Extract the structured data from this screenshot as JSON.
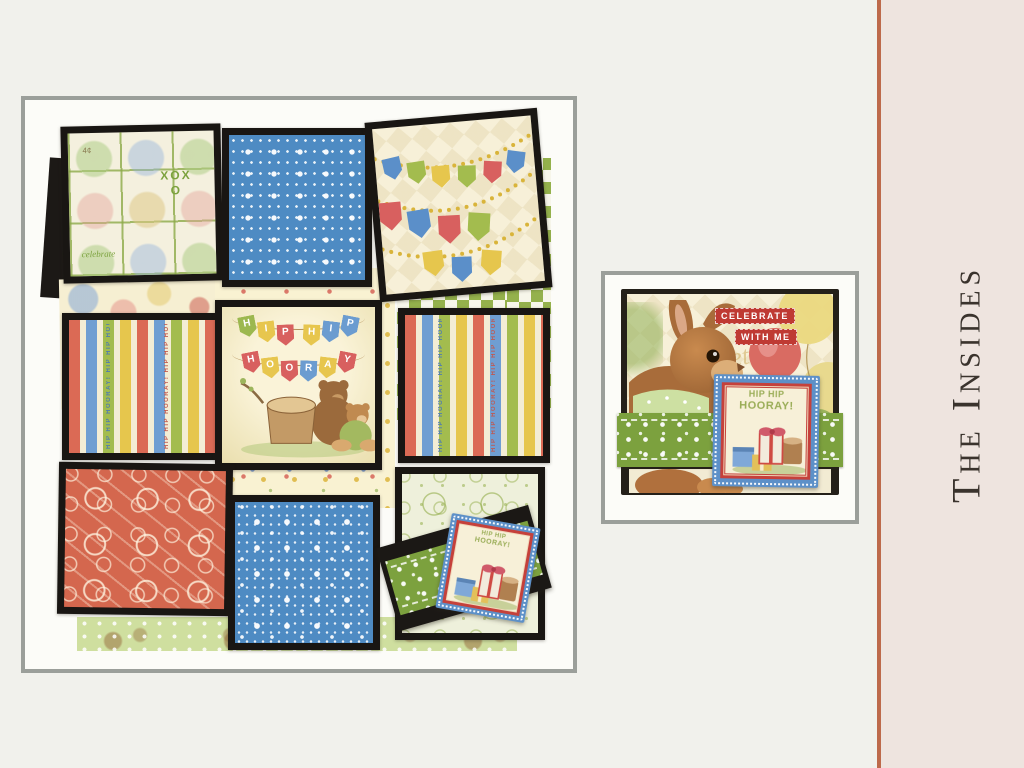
{
  "palette": {
    "page_bg": "#f1f1ec",
    "side_panel_bg": "#eee4df",
    "accent_line": "#bd6a4b",
    "title_color": "#3a332d",
    "frame_border": "#9b9f9a",
    "frame_mat": "#fcfcf8",
    "chipboard_black": "#191613",
    "paper_blue": "#4e8bc3",
    "paper_coral": "#d4674e",
    "paper_green": "#94b14c",
    "band_green": "#7ca13e",
    "tag_blue": "#5d90c8",
    "tag_red": "#c5413b",
    "badge_red": "#bf3a33"
  },
  "side_panel": {
    "title": "The Insides"
  },
  "left_photo": {
    "stamp_panel": {
      "xoxo": "XOXO",
      "price": "4¢",
      "script_word": "celebrate",
      "other_words": [
        "forever",
        "friends",
        "HIP HIP HOORAY!",
        "2¢",
        "3¢",
        "5¢"
      ]
    },
    "stripe_panel": {
      "text": "HIP HIP HOORAY! HIP HIP HOORAY! HIP HIP HOORAY!"
    },
    "center_panel": {
      "banner_top": "HIP HIP",
      "banner_bottom": "HOORAY"
    },
    "mini_tag": {
      "line1": "HIP HIP",
      "line2": "HOORAY!"
    }
  },
  "right_photo": {
    "badge": {
      "line1": "CELEBRATE",
      "line2": "WITH ME"
    },
    "script_text": "together",
    "tag": {
      "line1": "HIP HIP",
      "line2": "HOORAY!"
    }
  }
}
